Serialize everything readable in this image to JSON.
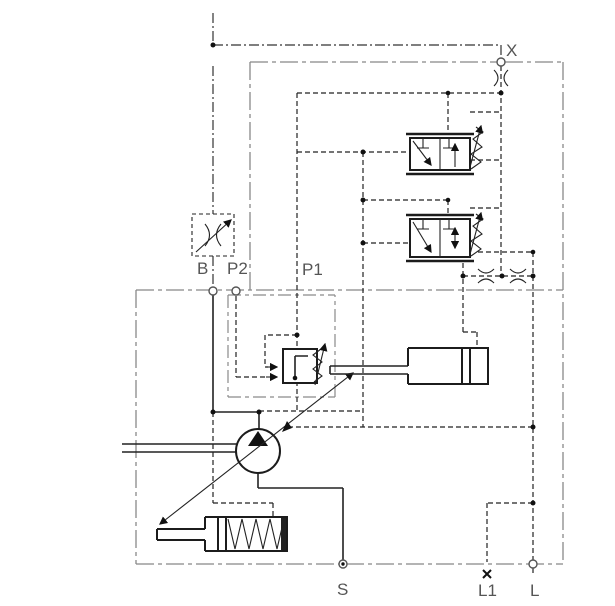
{
  "diagram": {
    "kind": "hydraulic-schematic",
    "ports": {
      "x": "X",
      "b": "B",
      "p2": "P2",
      "p1": "P1",
      "s": "S",
      "l1": "L1",
      "l": "L"
    },
    "components": {
      "pump": "variable-displacement-pump",
      "compensator": "pressure-compensator-valve",
      "control_piston": "stroking-control-cylinder",
      "bias_piston": "spring-bias-cylinder",
      "valve_upper": "pilot-pressure-valve-1",
      "valve_lower": "pilot-pressure-valve-2",
      "orifice_x": "fixed-orifice",
      "orifice_drain_1": "fixed-orifice",
      "orifice_drain_2": "fixed-orifice",
      "adjustable_orifice": "adjustable-orifice"
    },
    "colors": {
      "line": "#222222",
      "boundary": "#888888",
      "pilot_line": "#222222",
      "label": "#555555",
      "junction": "#111111",
      "background": "#ffffff"
    }
  }
}
